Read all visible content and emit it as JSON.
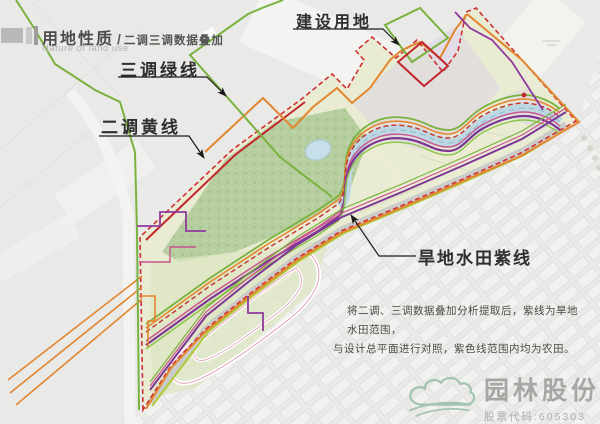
{
  "header": {
    "title_zh": "用地性质",
    "title_divider": "/",
    "subtitle_zh": "二调三调数据叠加",
    "subtitle_en": "Nature of land use"
  },
  "callouts": [
    {
      "id": "green-line",
      "label": "三调绿线"
    },
    {
      "id": "yellow-line",
      "label": "二调黄线"
    },
    {
      "id": "construction",
      "label": "建设用地"
    },
    {
      "id": "purple-line",
      "label": "旱地水田紫线"
    }
  ],
  "annotation": {
    "line1": "将二调、三调数据叠加分析提取后，紫线为旱地水田范围，",
    "line2": "与设计总平面进行对照，紫色线范围内均为农田。"
  },
  "watermark": {
    "company": "园林股份",
    "stock_code": "股票代码:605303"
  },
  "map": {
    "lines": [
      {
        "name": "三调绿线",
        "color": "#7ab23f"
      },
      {
        "name": "二调黄线",
        "color": "#e2862f"
      },
      {
        "name": "旱地水田紫线",
        "color": "#7e3796"
      },
      {
        "name": "建设用地红线",
        "color": "#c1272d"
      },
      {
        "name": "地块洋红线",
        "color": "#c9538f"
      }
    ],
    "fills": {
      "site": "#e9ecd2",
      "forest": "#b7cfa0",
      "lavender": "#d9cfe3",
      "river": "#bcd7e3",
      "background": "#e9e9e7"
    }
  }
}
